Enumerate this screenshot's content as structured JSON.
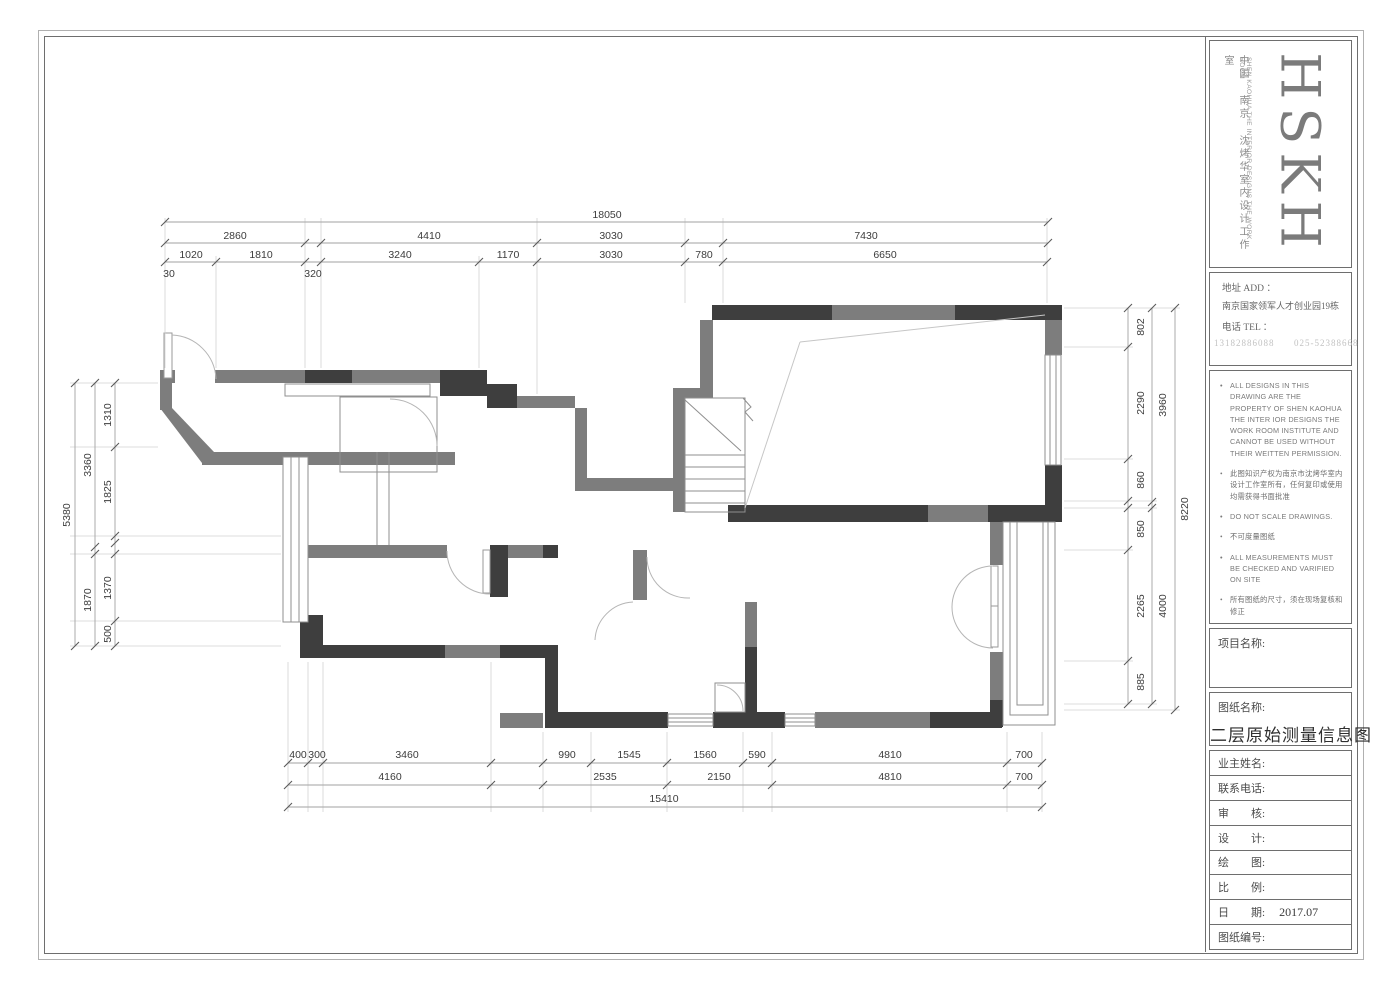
{
  "title_block": {
    "logo": {
      "monogram": "HSKH",
      "cn": "中国 南京 沈烤华室内设计工作室",
      "en": "SHEN KAOHUA THE INTERIOR DESIGNS THE WORK ROOM"
    },
    "address": {
      "addr_label": "地址 ADD ：",
      "addr_value": "南京国家领军人才创业园19栋",
      "tel_label": "电话 TEL ：",
      "tel_value": "13182886088      025-52388668"
    },
    "notes": [
      "ALL DESIGNS IN THIS DRAWING ARE THE PROPERTY OF SHEN KAOHUA THE INTER IOR DESIGNS THE WORK ROOM INSTITUTE AND CANNOT BE USED WITHOUT THEIR WEITTEN PERMISSION.",
      "此图知识产权为南京市沈烤华室内设计工作室所有，任何复印或使用均需获得书面批准",
      "DO NOT SCALE DRAWINGS.",
      "不可度量图纸",
      "ALL MEASUREMENTS MUST BE CHECKED AND VARIFIED ON SITE",
      "所有图纸的尺寸，须在现场复核和修正",
      "THE DRAWING IS NOT VALID FOR CONS TRUCTION UNLESS CERTIFIED",
      "除有批核外，本图不可用于施工"
    ],
    "project_label": "项目名称:",
    "drawing_label": "图纸名称:",
    "drawing_name": "二层原始测量信息图",
    "fields": [
      {
        "label": "业主姓名:",
        "value": ""
      },
      {
        "label": "联系电话:",
        "value": ""
      },
      {
        "label": "审　　核:",
        "value": ""
      },
      {
        "label": "设　　计:",
        "value": ""
      },
      {
        "label": "绘　　图:",
        "value": ""
      },
      {
        "label": "比　　例:",
        "value": ""
      },
      {
        "label": "日　　期:",
        "value": "2017.07"
      },
      {
        "label": "图纸编号:",
        "value": ""
      }
    ]
  },
  "dimensions": {
    "top": {
      "total": "18050",
      "row2": [
        "2860",
        "4410",
        "3030",
        "7430"
      ],
      "row3": [
        "1020",
        "1810",
        "3240",
        "1170",
        "3030",
        "780",
        "6650"
      ],
      "small": [
        "30",
        "320"
      ]
    },
    "bottom": {
      "row1": [
        "400",
        "300",
        "3460",
        "990",
        "1545",
        "1560",
        "590",
        "4810",
        "700"
      ],
      "row2": [
        "4160",
        "2535",
        "2150",
        "4810",
        "700"
      ],
      "total": "15410"
    },
    "left": {
      "total": "5380",
      "mid": [
        "3360",
        "1870"
      ],
      "inner": [
        "1310",
        "1825",
        "1370",
        "500"
      ]
    },
    "right": {
      "total": "8220",
      "mid": [
        "3960",
        "4000"
      ],
      "inner": [
        "802",
        "2290",
        "860",
        "850",
        "2265",
        "885"
      ]
    }
  },
  "colors": {
    "wall_dark": "#3e3e3e",
    "wall_gray": "#7d7d7d"
  }
}
